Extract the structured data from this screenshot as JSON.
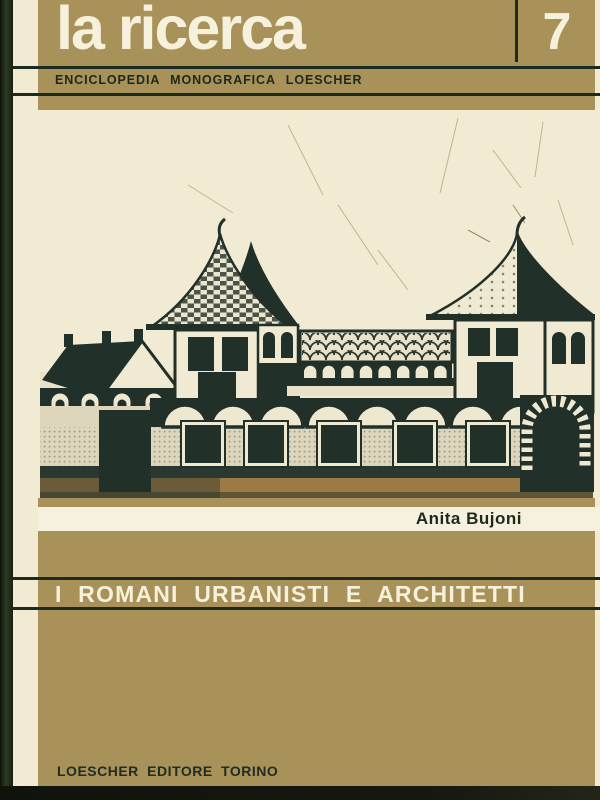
{
  "cover": {
    "series_title": "la ricerca",
    "series_number": "7",
    "series_subtitle": "ENCICLOPEDIA MONOGRAFICA LOESCHER",
    "author": "Anita Bujoni",
    "title": "I ROMANI URBANISTI E ARCHITETTI",
    "publisher": "LOESCHER EDITORE TORINO"
  },
  "illustration": {
    "description": "Naive ink drawing of a Roman villa: two square towers with pointed tiled roofs, a central arcaded gallery, a gabled outbuilding on the left, and a long front wall with five windows, a dark doorway and an arched stone gate over a brown ground strip."
  },
  "colors": {
    "band_tan": "#a89259",
    "paper_cream": "#f1ebd3",
    "author_strip_cream": "#f6f1de",
    "rule_dark_green": "#1b2b20",
    "text_dark": "#1c2a1e",
    "text_light": "#f6f1dc",
    "drawing_ink": "#22302a",
    "ground_brown": "#9c7a44",
    "scan_edge_black": "#191f12"
  }
}
